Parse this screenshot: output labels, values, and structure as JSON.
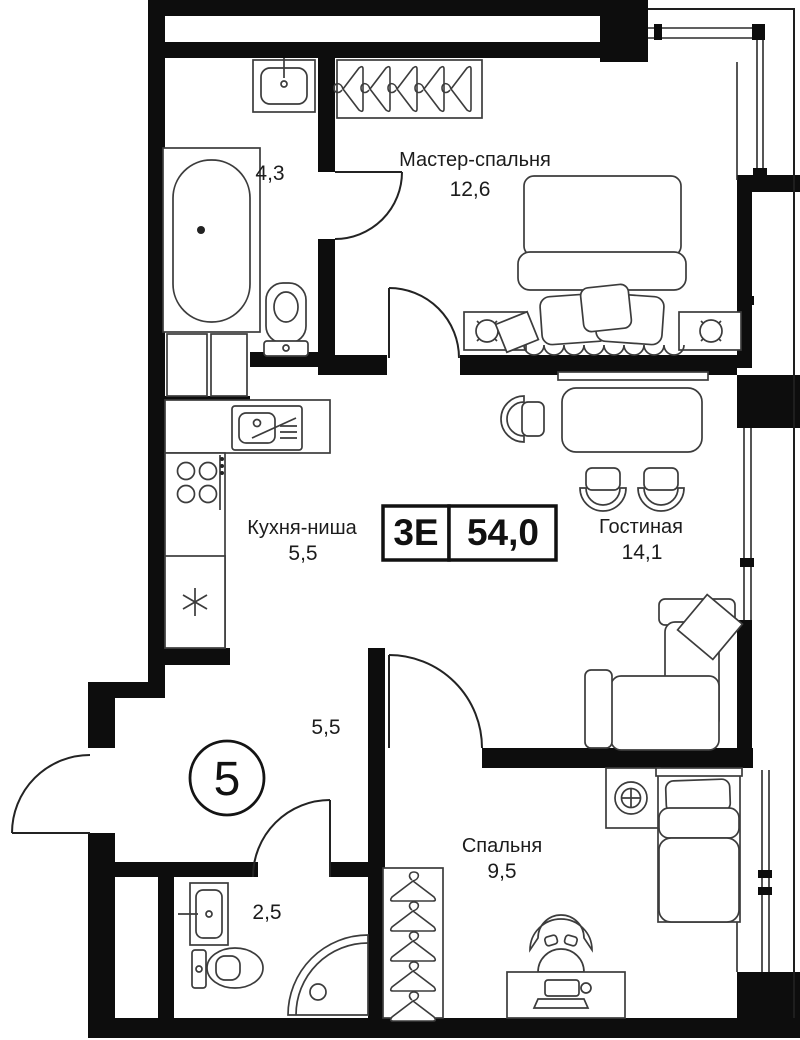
{
  "plan": {
    "unit_number": "5",
    "info_box": {
      "type": "3Е",
      "total_area": "54,0"
    },
    "rooms": [
      {
        "id": "master_bedroom",
        "name": "Мастер-спальня",
        "area": "12,6"
      },
      {
        "id": "bathroom_main",
        "name": "",
        "area": "4,3"
      },
      {
        "id": "kitchen_niche",
        "name": "Кухня-ниша",
        "area": "5,5"
      },
      {
        "id": "living_room",
        "name": "Гостиная",
        "area": "14,1"
      },
      {
        "id": "hallway",
        "name": "",
        "area": "5,5"
      },
      {
        "id": "bedroom",
        "name": "Спальня",
        "area": "9,5"
      },
      {
        "id": "bathroom_small",
        "name": "",
        "area": "2,5"
      }
    ],
    "colors": {
      "wall": "#0d0d0d",
      "line": "#3c3c3c",
      "background": "#ffffff",
      "text": "#1c1c1c"
    }
  }
}
